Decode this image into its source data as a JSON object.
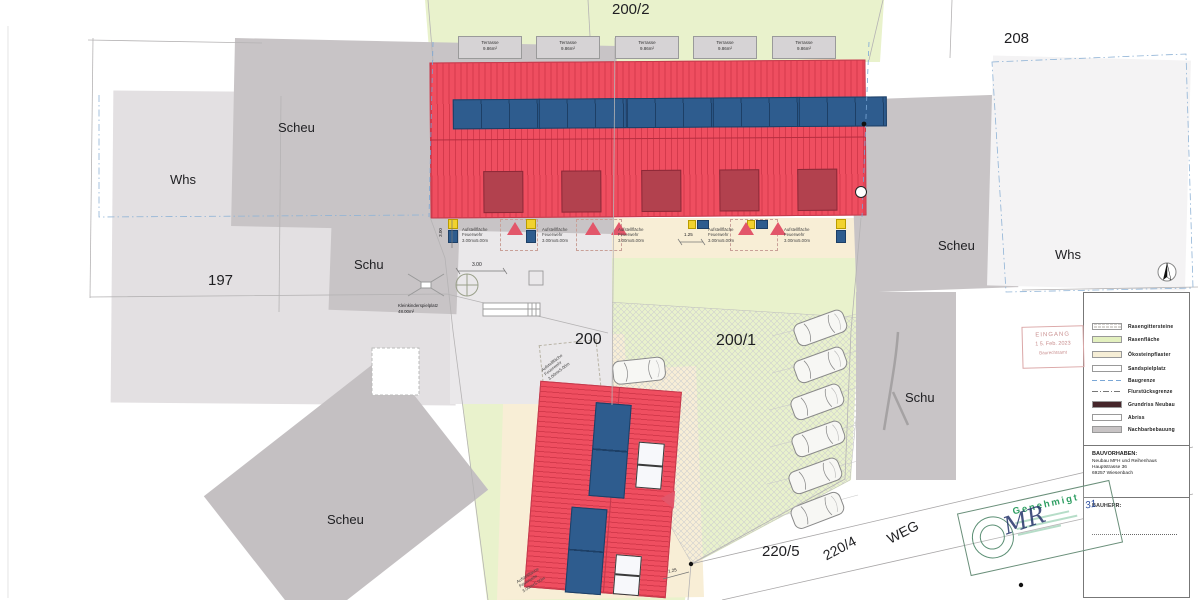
{
  "labels": {
    "parcel_200_2": "200/2",
    "parcel_208": "208",
    "parcel_197": "197",
    "parcel_200": "200",
    "parcel_200_1": "200/1",
    "parcel_220_5": "220/5",
    "parcel_220_4": "220/4",
    "weg": "WEG",
    "whs_left": "Whs",
    "scheu_left": "Scheu",
    "schu_left": "Schu",
    "scheu_bottom": "Scheu",
    "scheu_right": "Scheu",
    "whs_right": "Whs",
    "schu_right": "Schu"
  },
  "annotations": {
    "terrace_line1": "Terrasse",
    "terrace_line2": "9.86m²",
    "fire_line1": "Aufstellfläche",
    "fire_line2": "Feuerwehr",
    "fire_line3": "3.00mx5.00m",
    "playground_line1": "Kleinkinderspielplatz",
    "playground_line2": "48.00m²",
    "dim_3_00": "3.00",
    "dim_1_25": "1.25"
  },
  "legend": {
    "items": [
      {
        "label": "Rasengittersteine"
      },
      {
        "label": "Rasenfläche"
      },
      {
        "label": "Ökosteinpflaster"
      },
      {
        "label": "Sandspielplatz"
      },
      {
        "label": "Baugrenze"
      },
      {
        "label": "Flurstücksgrenze"
      },
      {
        "label": "Grundriss Neubau"
      },
      {
        "label": "Abriss"
      },
      {
        "label": "Nachbarbebauung"
      }
    ],
    "project_label": "BAUVORHABEN:",
    "project_line1": "Neubau MFH und Reihenhaus",
    "project_line2": "Hauptstrasse 36",
    "project_line3": "69257 Wiesenbach",
    "client_label": "BAUHERR:"
  },
  "stamps": {
    "received_line1": "EINGANG",
    "received_line2": "1 5. Feb. 2023",
    "received_line3": "Baurechtsamt",
    "approved_title": "Genehmigt",
    "approved_signature": "MR",
    "approved_number": "31"
  },
  "colors": {
    "new_building": "#ee4d5f",
    "solar_panel": "#2e5c8e",
    "lawn": "#e9f2cc",
    "paving": "#f8eed6",
    "neighbor_building": "#c8c4c6",
    "boundary_blue": "#7aa7d6",
    "stamp_red": "#cc7f7f",
    "stamp_green": "#2e9e62"
  }
}
